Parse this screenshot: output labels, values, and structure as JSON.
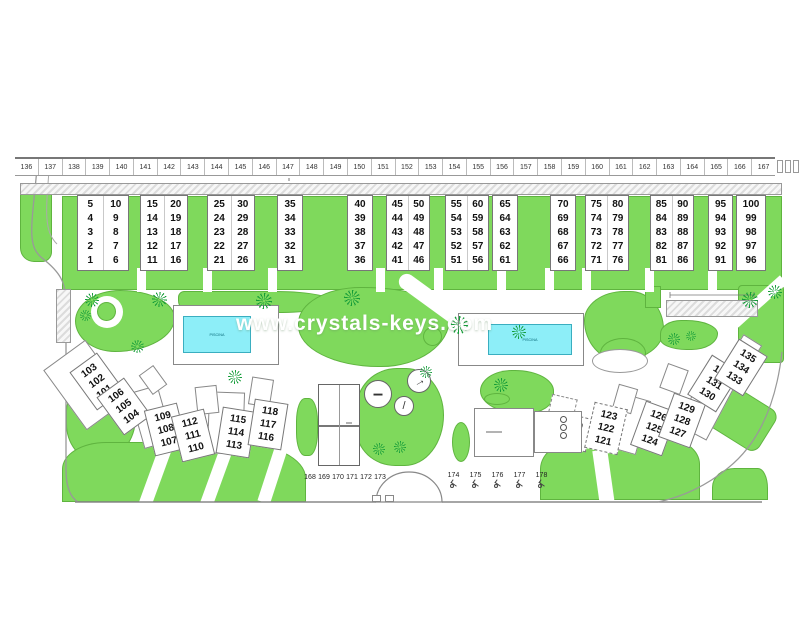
{
  "watermark": {
    "text": "www.crystals-keys.com"
  },
  "colors": {
    "garden_green": "#7fd95c",
    "pool_water": "#8deef8",
    "pool_border": "#3aaec0",
    "outline": "#888888"
  },
  "top_parking": {
    "numbers": [
      "136",
      "137",
      "138",
      "139",
      "140",
      "141",
      "142",
      "143",
      "144",
      "145",
      "146",
      "147",
      "148",
      "149",
      "150",
      "151",
      "152",
      "153",
      "154",
      "155",
      "156",
      "157",
      "158",
      "159",
      "160",
      "161",
      "162",
      "163",
      "164",
      "165",
      "166",
      "167"
    ],
    "unnumbered": [
      "",
      "",
      ""
    ]
  },
  "upper_blocks": [
    [
      [
        "5",
        "4",
        "3",
        "2",
        "1"
      ],
      [
        "10",
        "9",
        "8",
        "7",
        "6"
      ]
    ],
    [
      [
        "15",
        "14",
        "13",
        "12",
        "11"
      ],
      [
        "20",
        "19",
        "18",
        "17",
        "16"
      ]
    ],
    [
      [
        "25",
        "24",
        "23",
        "22",
        "21"
      ],
      [
        "30",
        "29",
        "28",
        "27",
        "26"
      ]
    ],
    [
      [
        "35",
        "34",
        "33",
        "32",
        "31"
      ]
    ],
    [
      [
        "40",
        "39",
        "38",
        "37",
        "36"
      ]
    ],
    [
      [
        "45",
        "44",
        "43",
        "42",
        "41"
      ],
      [
        "50",
        "49",
        "48",
        "47",
        "46"
      ]
    ],
    [
      [
        "55",
        "54",
        "53",
        "52",
        "51"
      ],
      [
        "60",
        "59",
        "58",
        "57",
        "56"
      ]
    ],
    [
      [
        "65",
        "64",
        "63",
        "62",
        "61"
      ]
    ],
    [
      [
        "70",
        "69",
        "68",
        "67",
        "66"
      ]
    ],
    [
      [
        "75",
        "74",
        "73",
        "72",
        "71"
      ],
      [
        "80",
        "79",
        "78",
        "77",
        "76"
      ]
    ],
    [
      [
        "85",
        "84",
        "83",
        "82",
        "81"
      ],
      [
        "90",
        "89",
        "88",
        "87",
        "86"
      ]
    ],
    [
      [
        "95",
        "94",
        "93",
        "92",
        "91"
      ]
    ],
    [
      [
        "100",
        "99",
        "98",
        "97",
        "96"
      ]
    ]
  ],
  "lower_left_blocks": [
    [
      "103",
      "102",
      "101"
    ],
    [
      "106",
      "105",
      "104"
    ],
    [
      "109",
      "108",
      "107"
    ],
    [
      "112",
      "111",
      "110"
    ],
    [
      "115",
      "114",
      "113"
    ],
    [
      "118",
      "117",
      "116"
    ]
  ],
  "lower_right_blocks": [
    [
      "120",
      "119"
    ],
    [
      "123",
      "122",
      "121"
    ],
    [
      "126",
      "125",
      "124"
    ],
    [
      "129",
      "128",
      "127"
    ],
    [
      "132",
      "131",
      "130"
    ],
    [
      "135",
      "134",
      "133"
    ]
  ],
  "bottom_parking": {
    "left_numbers": [
      "168",
      "169",
      "170",
      "171",
      "172",
      "173"
    ],
    "right_numbers": [
      "174",
      "175",
      "176",
      "177",
      "178"
    ]
  },
  "pools": {
    "pool1_label": "PISCINA",
    "pool2_label": "PISCINA"
  }
}
